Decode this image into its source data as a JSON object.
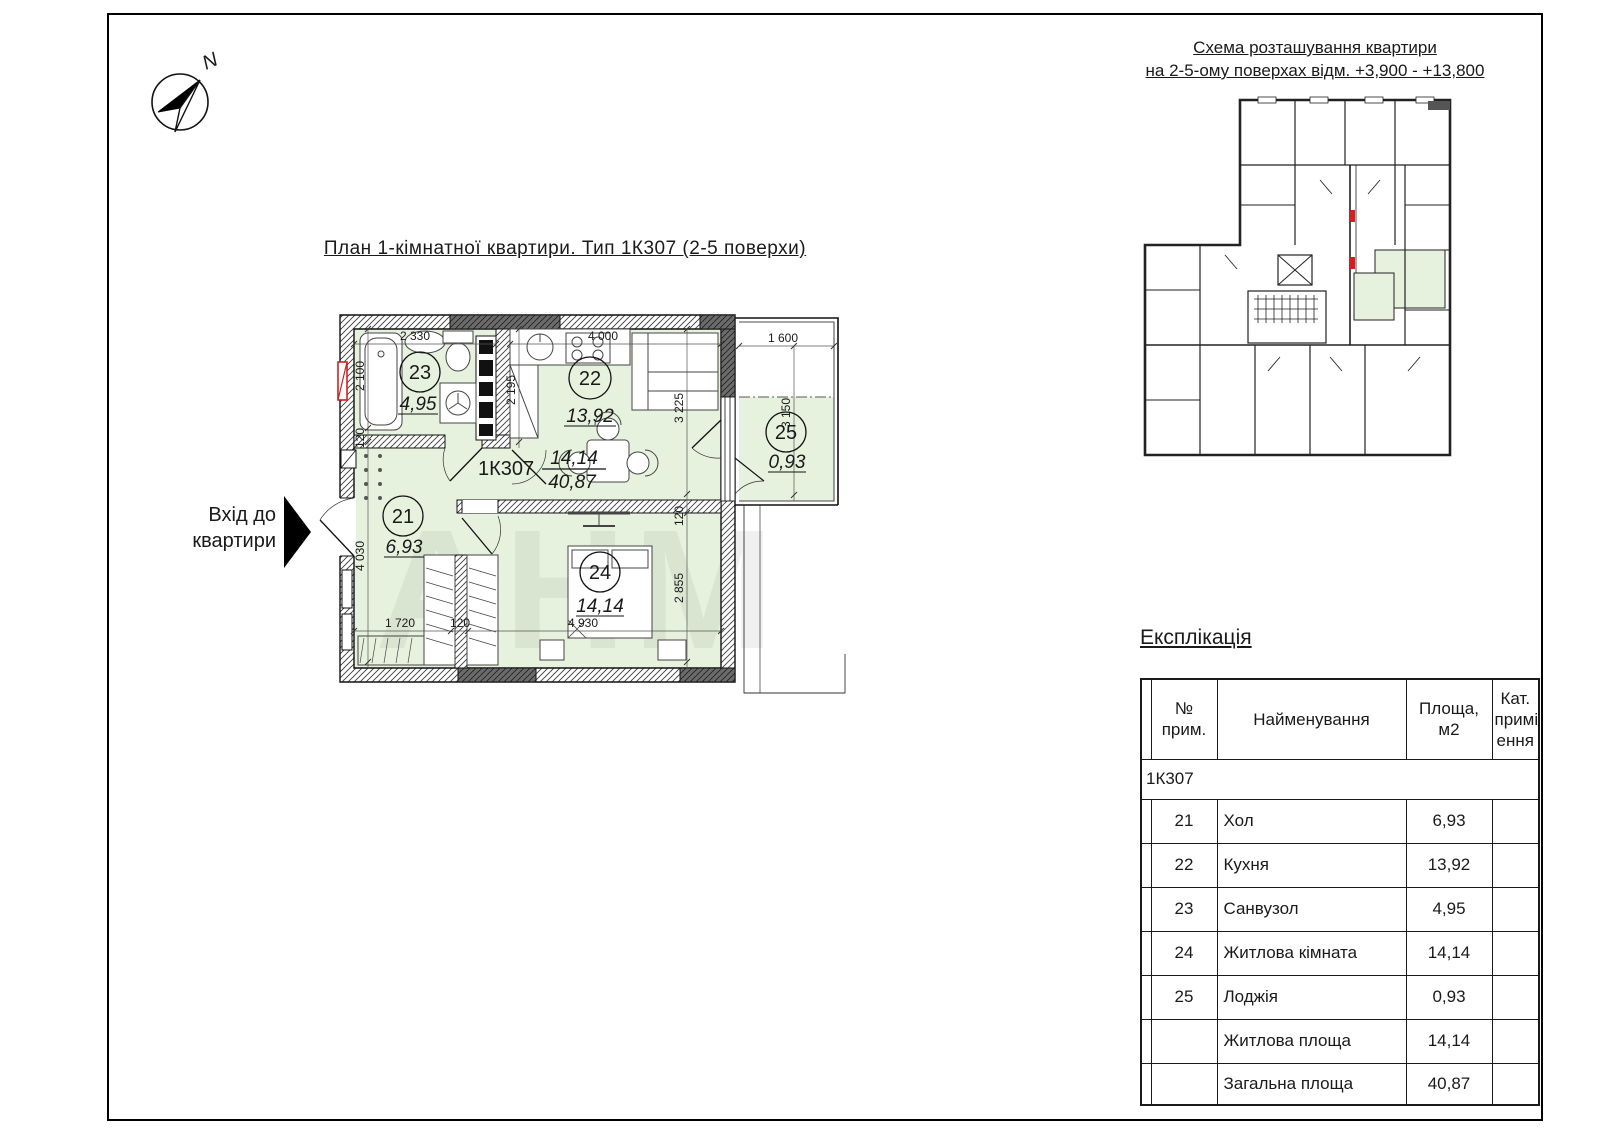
{
  "page": {
    "north_label": "N",
    "watermark": "АНМ"
  },
  "main_plan": {
    "title": "План 1-кімнатної квартири. Тип 1К307 (2-5 поверхи)",
    "entrance_line1": "Вхід до",
    "entrance_line2": "квартири",
    "type_label": "1К307",
    "living_area": "14,14",
    "total_area": "40,87",
    "rooms": {
      "r21": {
        "num": "21",
        "area": "6,93"
      },
      "r22": {
        "num": "22",
        "area": "13,92"
      },
      "r23": {
        "num": "23",
        "area": "4,95"
      },
      "r24": {
        "num": "24",
        "area": "14,14"
      },
      "r25": {
        "num": "25",
        "area": "0,93"
      }
    },
    "dimensions": [
      "2 330",
      "4 000",
      "1 600",
      "2 100",
      "120",
      "2 195",
      "3 225",
      "3 150",
      "4 030",
      "120",
      "2 855",
      "1 720",
      "120",
      "4 930"
    ]
  },
  "scheme": {
    "title_line1": "Схема розташування квартири",
    "title_line2": "на 2-5-ому поверхах відм. +3,900 - +13,800"
  },
  "explication": {
    "title": "Експлікація",
    "columns": [
      "№\nприм.",
      "Найменування",
      "Площа,\nм2",
      "Кат.\nприміщ\nення"
    ],
    "group_row": "1К307",
    "rows": [
      {
        "num": "21",
        "name": "Хол",
        "area": "6,93",
        "cat": ""
      },
      {
        "num": "22",
        "name": "Кухня",
        "area": "13,92",
        "cat": ""
      },
      {
        "num": "23",
        "name": "Санвузол",
        "area": "4,95",
        "cat": ""
      },
      {
        "num": "24",
        "name": "Житлова кімната",
        "area": "14,14",
        "cat": ""
      },
      {
        "num": "25",
        "name": "Лоджія",
        "area": "0,93",
        "cat": ""
      }
    ],
    "totals": [
      {
        "name": "Житлова площа",
        "area": "14,14"
      },
      {
        "name": "Загальна площа",
        "area": "40,87"
      }
    ]
  },
  "colors": {
    "room_fill": "#e6f2de",
    "wall_dark": "#5d5d5d",
    "line": "#1a1a1a",
    "red_accent": "#cc2222"
  }
}
